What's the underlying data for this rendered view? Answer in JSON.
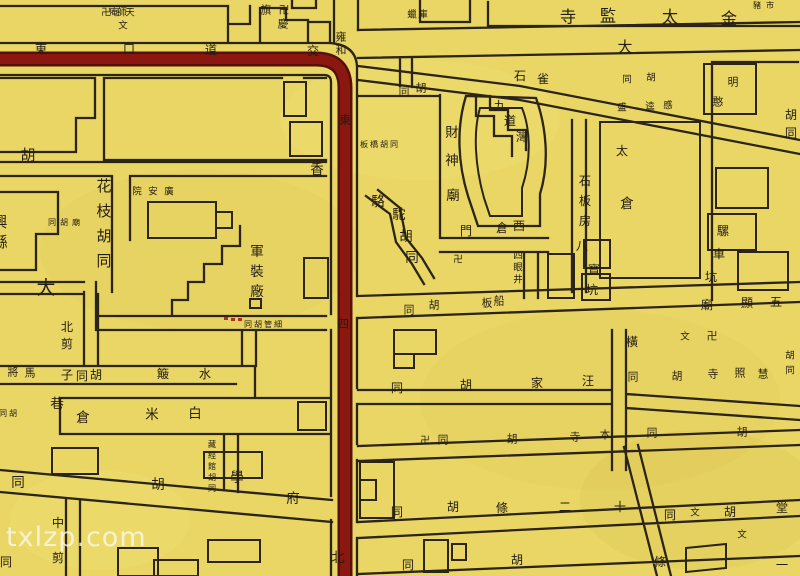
{
  "map": {
    "watermark": "txlzp.com",
    "colors": {
      "paper": "#e9d664",
      "ink": "#2b2418",
      "road_red": "#8a1710",
      "road_red_dark": "#55100a",
      "watermark_color": "rgba(250,250,240,0.78)"
    },
    "labels": [
      {
        "t": "卍庵師天",
        "x": 106,
        "y": 13,
        "s": 7,
        "d": "h",
        "g": 8
      },
      {
        "t": "文",
        "x": 123,
        "y": 26,
        "s": 7
      },
      {
        "t": "旗",
        "x": 266,
        "y": 10,
        "s": 8
      },
      {
        "t": "卍",
        "x": 284,
        "y": 10,
        "s": 8
      },
      {
        "t": "慶",
        "x": 283,
        "y": 24,
        "s": 8
      },
      {
        "t": "蠟庫",
        "x": 412,
        "y": 15,
        "s": 7,
        "d": "h",
        "g": 11
      },
      {
        "t": "豬市",
        "x": 757,
        "y": 5,
        "s": 6,
        "d": "h",
        "g": 13
      },
      {
        "t": "寺",
        "x": 568,
        "y": 17,
        "s": 12
      },
      {
        "t": "監",
        "x": 608,
        "y": 16,
        "s": 12
      },
      {
        "t": "太",
        "x": 670,
        "y": 17,
        "s": 12
      },
      {
        "t": "金",
        "x": 729,
        "y": 19,
        "s": 12
      },
      {
        "t": "東",
        "x": 41,
        "y": 49,
        "s": 9
      },
      {
        "t": "口",
        "x": 129,
        "y": 49,
        "s": 9
      },
      {
        "t": "道",
        "x": 211,
        "y": 50,
        "s": 9
      },
      {
        "t": "交",
        "x": 313,
        "y": 51,
        "s": 9
      },
      {
        "t": "雍和",
        "x": 341,
        "y": 37,
        "s": 8,
        "d": "v",
        "g": 13
      },
      {
        "t": "大",
        "x": 625,
        "y": 47,
        "s": 11
      },
      {
        "t": "東",
        "x": 345,
        "y": 120,
        "s": 9
      },
      {
        "t": "四",
        "x": 343,
        "y": 324,
        "s": 9
      },
      {
        "t": "北",
        "x": 338,
        "y": 558,
        "s": 10
      },
      {
        "t": "胡",
        "x": 28,
        "y": 155,
        "s": 11
      },
      {
        "t": "同",
        "x": 404,
        "y": 91,
        "s": 8
      },
      {
        "t": "胡",
        "x": 421,
        "y": 88,
        "s": 8
      },
      {
        "t": "石",
        "x": 520,
        "y": 76,
        "s": 9
      },
      {
        "t": "雀",
        "x": 543,
        "y": 79,
        "s": 9
      },
      {
        "t": "同",
        "x": 627,
        "y": 80,
        "s": 7
      },
      {
        "t": "胡",
        "x": 651,
        "y": 78,
        "s": 7
      },
      {
        "t": "明",
        "x": 733,
        "y": 82,
        "s": 8
      },
      {
        "t": "盛",
        "x": 622,
        "y": 108,
        "s": 7
      },
      {
        "t": "逵",
        "x": 650,
        "y": 107,
        "s": 7
      },
      {
        "t": "慼",
        "x": 668,
        "y": 106,
        "s": 7
      },
      {
        "t": "憨",
        "x": 718,
        "y": 102,
        "s": 8
      },
      {
        "t": "九",
        "x": 500,
        "y": 106,
        "s": 9
      },
      {
        "t": "道",
        "x": 510,
        "y": 121,
        "s": 9
      },
      {
        "t": "灣",
        "x": 522,
        "y": 137,
        "s": 9
      },
      {
        "t": "板橋胡同",
        "x": 364,
        "y": 144,
        "s": 6,
        "d": "h",
        "g": 10
      },
      {
        "t": "財",
        "x": 452,
        "y": 133,
        "s": 10
      },
      {
        "t": "神",
        "x": 452,
        "y": 161,
        "s": 10
      },
      {
        "t": "廟",
        "x": 453,
        "y": 196,
        "s": 10
      },
      {
        "t": "太",
        "x": 622,
        "y": 151,
        "s": 9
      },
      {
        "t": "倉",
        "x": 627,
        "y": 204,
        "s": 10
      },
      {
        "t": "石板房",
        "x": 585,
        "y": 181,
        "s": 9,
        "d": "v",
        "g": 20
      },
      {
        "t": "駱",
        "x": 378,
        "y": 202,
        "s": 10
      },
      {
        "t": "駝",
        "x": 399,
        "y": 215,
        "s": 10
      },
      {
        "t": "胡",
        "x": 406,
        "y": 237,
        "s": 10
      },
      {
        "t": "同",
        "x": 412,
        "y": 258,
        "s": 10
      },
      {
        "t": "門",
        "x": 466,
        "y": 231,
        "s": 9
      },
      {
        "t": "倉",
        "x": 502,
        "y": 228,
        "s": 9
      },
      {
        "t": "西",
        "x": 519,
        "y": 226,
        "s": 9
      },
      {
        "t": "四眼井",
        "x": 518,
        "y": 256,
        "s": 7,
        "d": "v",
        "g": 12
      },
      {
        "t": "卍",
        "x": 458,
        "y": 260,
        "s": 7
      },
      {
        "t": "八",
        "x": 582,
        "y": 246,
        "s": 9
      },
      {
        "t": "寶",
        "x": 594,
        "y": 270,
        "s": 9
      },
      {
        "t": "坑",
        "x": 592,
        "y": 290,
        "s": 9
      },
      {
        "t": "騾",
        "x": 723,
        "y": 231,
        "s": 9
      },
      {
        "t": "車",
        "x": 719,
        "y": 254,
        "s": 9
      },
      {
        "t": "坑",
        "x": 711,
        "y": 277,
        "s": 9
      },
      {
        "t": "胡同",
        "x": 791,
        "y": 115,
        "s": 9,
        "d": "v",
        "g": 18
      },
      {
        "t": "船",
        "x": 499,
        "y": 301,
        "s": 8
      },
      {
        "t": "板",
        "x": 487,
        "y": 303,
        "s": 8
      },
      {
        "t": "胡",
        "x": 434,
        "y": 305,
        "s": 8
      },
      {
        "t": "同",
        "x": 409,
        "y": 310,
        "s": 8
      },
      {
        "t": "五",
        "x": 776,
        "y": 302,
        "s": 9
      },
      {
        "t": "顯",
        "x": 747,
        "y": 303,
        "s": 9
      },
      {
        "t": "廟",
        "x": 707,
        "y": 305,
        "s": 9
      },
      {
        "t": "香",
        "x": 317,
        "y": 170,
        "s": 10
      },
      {
        "t": "文",
        "x": 685,
        "y": 337,
        "s": 7
      },
      {
        "t": "卍",
        "x": 712,
        "y": 336,
        "s": 8
      },
      {
        "t": "橫",
        "x": 632,
        "y": 342,
        "s": 9
      },
      {
        "t": "胡同",
        "x": 790,
        "y": 356,
        "s": 7,
        "d": "v",
        "g": 15
      },
      {
        "t": "慧",
        "x": 763,
        "y": 374,
        "s": 8
      },
      {
        "t": "照",
        "x": 740,
        "y": 373,
        "s": 8
      },
      {
        "t": "寺",
        "x": 713,
        "y": 374,
        "s": 8
      },
      {
        "t": "胡",
        "x": 677,
        "y": 376,
        "s": 8
      },
      {
        "t": "同",
        "x": 633,
        "y": 377,
        "s": 8
      },
      {
        "t": "汪",
        "x": 588,
        "y": 381,
        "s": 9
      },
      {
        "t": "家",
        "x": 537,
        "y": 383,
        "s": 9
      },
      {
        "t": "胡",
        "x": 466,
        "y": 385,
        "s": 9
      },
      {
        "t": "同",
        "x": 397,
        "y": 388,
        "s": 9
      },
      {
        "t": "卍",
        "x": 425,
        "y": 441,
        "s": 7
      },
      {
        "t": "同",
        "x": 443,
        "y": 440,
        "s": 8
      },
      {
        "t": "胡",
        "x": 512,
        "y": 439,
        "s": 8
      },
      {
        "t": "寺",
        "x": 575,
        "y": 437,
        "s": 8
      },
      {
        "t": "本",
        "x": 605,
        "y": 435,
        "s": 8
      },
      {
        "t": "同",
        "x": 652,
        "y": 433,
        "s": 8
      },
      {
        "t": "胡",
        "x": 742,
        "y": 432,
        "s": 8
      },
      {
        "t": "十",
        "x": 620,
        "y": 507,
        "s": 9
      },
      {
        "t": "二",
        "x": 565,
        "y": 507,
        "s": 9
      },
      {
        "t": "條",
        "x": 502,
        "y": 508,
        "s": 9
      },
      {
        "t": "胡",
        "x": 453,
        "y": 507,
        "s": 9
      },
      {
        "t": "同",
        "x": 397,
        "y": 512,
        "s": 9
      },
      {
        "t": "堂",
        "x": 782,
        "y": 508,
        "s": 9
      },
      {
        "t": "胡",
        "x": 730,
        "y": 512,
        "s": 9
      },
      {
        "t": "文",
        "x": 695,
        "y": 513,
        "s": 7
      },
      {
        "t": "同",
        "x": 670,
        "y": 515,
        "s": 9
      },
      {
        "t": "文",
        "x": 742,
        "y": 535,
        "s": 7
      },
      {
        "t": "一",
        "x": 782,
        "y": 565,
        "s": 9
      },
      {
        "t": "條",
        "x": 660,
        "y": 562,
        "s": 9
      },
      {
        "t": "胡",
        "x": 517,
        "y": 560,
        "s": 9
      },
      {
        "t": "同",
        "x": 408,
        "y": 565,
        "s": 9
      },
      {
        "t": "同胡管細",
        "x": 248,
        "y": 324,
        "s": 6,
        "d": "h",
        "g": 10
      },
      {
        "t": "軍裝廠",
        "x": 257,
        "y": 252,
        "s": 10,
        "d": "v",
        "g": 20
      },
      {
        "t": "花枝胡同",
        "x": 104,
        "y": 186,
        "s": 11,
        "d": "v",
        "g": 25
      },
      {
        "t": "院安廣",
        "x": 137,
        "y": 192,
        "s": 7,
        "d": "h",
        "g": 16
      },
      {
        "t": "同胡廟",
        "x": 52,
        "y": 222,
        "s": 6,
        "d": "h",
        "g": 12
      },
      {
        "t": "大",
        "x": 46,
        "y": 288,
        "s": 14
      },
      {
        "t": "興縣",
        "x": 0,
        "y": 222,
        "s": 11,
        "d": "v",
        "g": 20
      },
      {
        "t": "北剪",
        "x": 67,
        "y": 327,
        "s": 9,
        "d": "v",
        "g": 17
      },
      {
        "t": "子",
        "x": 67,
        "y": 375,
        "s": 9
      },
      {
        "t": "同",
        "x": 82,
        "y": 376,
        "s": 9
      },
      {
        "t": "胡",
        "x": 96,
        "y": 375,
        "s": 9
      },
      {
        "t": "將",
        "x": 13,
        "y": 372,
        "s": 8
      },
      {
        "t": "馬",
        "x": 30,
        "y": 373,
        "s": 8
      },
      {
        "t": "簸",
        "x": 163,
        "y": 374,
        "s": 9
      },
      {
        "t": "水",
        "x": 205,
        "y": 374,
        "s": 9
      },
      {
        "t": "巷",
        "x": 57,
        "y": 404,
        "s": 10
      },
      {
        "t": "倉",
        "x": 83,
        "y": 418,
        "s": 10
      },
      {
        "t": "米",
        "x": 152,
        "y": 415,
        "s": 10
      },
      {
        "t": "白",
        "x": 195,
        "y": 414,
        "s": 10
      },
      {
        "t": "同胡",
        "x": 3,
        "y": 413,
        "s": 6,
        "d": "h",
        "g": 10
      },
      {
        "t": "藏經館胡同",
        "x": 212,
        "y": 444,
        "s": 6,
        "d": "v",
        "g": 11
      },
      {
        "t": "府",
        "x": 293,
        "y": 499,
        "s": 10
      },
      {
        "t": "學",
        "x": 237,
        "y": 478,
        "s": 10
      },
      {
        "t": "胡",
        "x": 158,
        "y": 485,
        "s": 10
      },
      {
        "t": "同",
        "x": 18,
        "y": 483,
        "s": 10
      },
      {
        "t": "中剪",
        "x": 58,
        "y": 523,
        "s": 9,
        "d": "v",
        "g": 35
      },
      {
        "t": "同",
        "x": 6,
        "y": 562,
        "s": 9
      }
    ]
  }
}
